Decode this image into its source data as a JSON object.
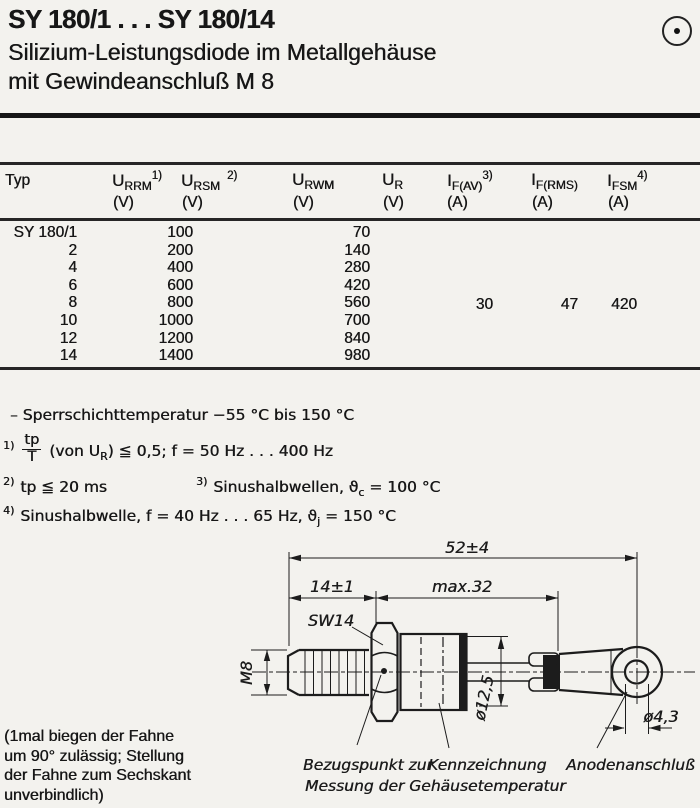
{
  "header": {
    "title": "SY 180/1 . . . SY 180/14",
    "subtitle_line1": "Silizium-Leistungsdiode im Metallgehäuse",
    "subtitle_line2": "mit Gewindeanschluß M 8",
    "polarity_icon": "circle-dot"
  },
  "table": {
    "headers": {
      "typ": "Typ",
      "u_rrm": {
        "sym": "U",
        "sub": "RRM",
        "sup": "1)",
        "unit": "(V)"
      },
      "u_rsm": {
        "sym": "U",
        "sub": "RSM",
        "sup": "2)",
        "unit": "(V)"
      },
      "u_rwm": {
        "sym": "U",
        "sub": "RWM",
        "unit": "(V)"
      },
      "u_r": {
        "sym": "U",
        "sub": "R",
        "unit": "(V)"
      },
      "i_fav": {
        "sym": "I",
        "sub": "F(AV)",
        "sup": "3)",
        "unit": "(A)"
      },
      "i_frms": {
        "sym": "I",
        "sub": "F(RMS)",
        "unit": "(A)"
      },
      "i_fsm": {
        "sym": "I",
        "sub": "FSM",
        "sup": "4)",
        "unit": "(A)"
      }
    },
    "rows": [
      {
        "typ": "SY 180/1",
        "u_rrm_rsm": "100",
        "u_rwm": "70"
      },
      {
        "typ": "2",
        "u_rrm_rsm": "200",
        "u_rwm": "140"
      },
      {
        "typ": "4",
        "u_rrm_rsm": "400",
        "u_rwm": "280"
      },
      {
        "typ": "6",
        "u_rrm_rsm": "600",
        "u_rwm": "420"
      },
      {
        "typ": "8",
        "u_rrm_rsm": "800",
        "u_rwm": "560"
      },
      {
        "typ": "10",
        "u_rrm_rsm": "1000",
        "u_rwm": "700"
      },
      {
        "typ": "12",
        "u_rrm_rsm": "1200",
        "u_rwm": "840"
      },
      {
        "typ": "14",
        "u_rrm_rsm": "1400",
        "u_rwm": "980"
      }
    ],
    "shared_values": {
      "i_fav": "30",
      "i_frms": "47",
      "i_fsm": "420"
    }
  },
  "notes": {
    "temp": "– Sperrschichttemperatur  −55 °C bis 150 °C",
    "fn1": {
      "marker": "1)",
      "frac_top": "tp",
      "frac_bot": "T",
      "pre": "(von U",
      "sub": "R",
      "post": ") ≦ 0,5;  f = 50 Hz . . . 400 Hz"
    },
    "fn2": {
      "marker": "2)",
      "text": "tp ≦ 20 ms"
    },
    "fn3": {
      "marker": "3)",
      "pre": "Sinushalbwellen,  ϑ",
      "sub": "c",
      "post": " = 100 °C"
    },
    "fn4": {
      "marker": "4)",
      "pre": "Sinushalbwelle, f = 40 Hz . . . 65 Hz,  ϑ",
      "sub": "j",
      "post": " = 150 °C"
    }
  },
  "drawing": {
    "dim_52": "52±4",
    "dim_14": "14±1",
    "dim_32": "max.32",
    "sw14": "SW14",
    "m8": "M8",
    "dia_125": "ø12,5",
    "dia_43": "ø4,3",
    "cap_bezug_1": "Bezugspunkt zur",
    "cap_bezug_2": "Messung der Gehäusetemperatur",
    "cap_kenn": "Kennzeichnung",
    "cap_anode": "Anodenanschluß"
  },
  "side_note": {
    "line1": "(1mal biegen der Fahne",
    "line2": "um 90° zulässig; Stellung",
    "line3": "der Fahne zum Sechskant",
    "line4": "unverbindlich)"
  }
}
